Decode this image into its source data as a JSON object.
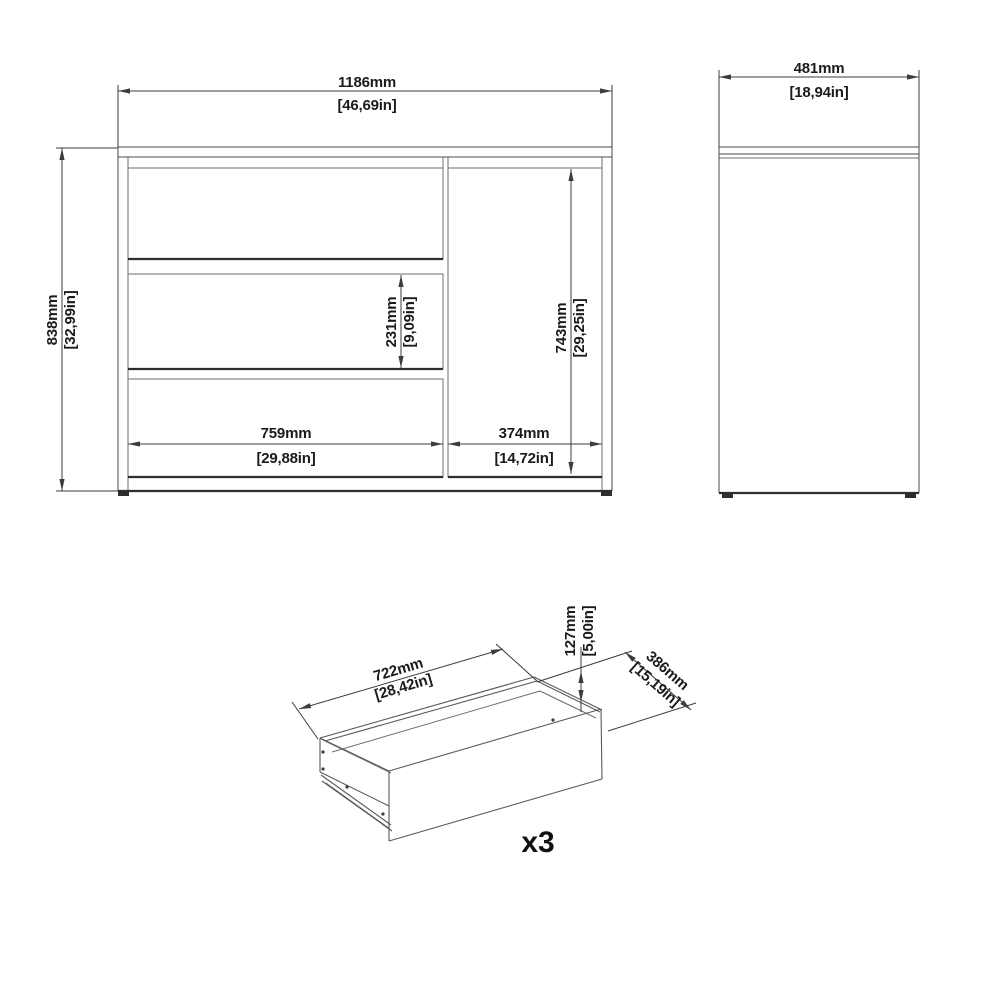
{
  "diagram": {
    "type": "furniture-dimension-drawing",
    "views": [
      "front-elevation",
      "side-elevation",
      "drawer-isometric-detail"
    ]
  },
  "front_view": {
    "overall_width": {
      "mm": "1186mm",
      "inch": "[46,69in]"
    },
    "overall_height": {
      "mm": "838mm",
      "inch": "[32,99in]"
    },
    "drawer_section_width": {
      "mm": "759mm",
      "inch": "[29,88in]"
    },
    "door_section_width": {
      "mm": "374mm",
      "inch": "[14,72in]"
    },
    "drawer_front_height": {
      "mm": "231mm",
      "inch": "[9,09in]"
    },
    "door_height": {
      "mm": "743mm",
      "inch": "[29,25in]"
    }
  },
  "side_view": {
    "overall_depth": {
      "mm": "481mm",
      "inch": "[18,94in]"
    }
  },
  "drawer_detail": {
    "inner_width": {
      "mm": "722mm",
      "inch": "[28,42in]"
    },
    "front_height": {
      "mm": "127mm",
      "inch": "[5,00in]"
    },
    "inner_depth": {
      "mm": "386mm",
      "inch": "[15,19in]"
    },
    "quantity_label": "x3"
  },
  "colors": {
    "background": "#ffffff",
    "line": "#5a5a5a",
    "line_dark": "#2e2e2e",
    "dimension_line": "#3c3c3c",
    "text": "#1b1b1b"
  }
}
